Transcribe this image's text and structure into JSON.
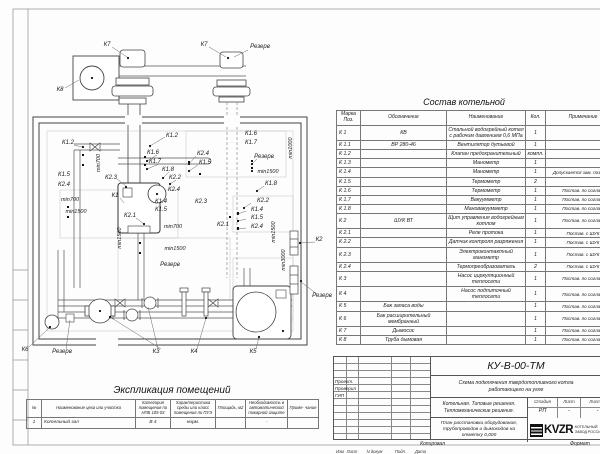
{
  "drawing": {
    "labels": [
      "К7",
      "К7",
      "Резерв",
      "К8",
      "К1.2",
      "min700",
      "К1.5",
      "К2.4",
      "min700",
      "min1500",
      "К1.2",
      "К1.6",
      "К1.7",
      "К1.8",
      "К2.2",
      "К2.3",
      "К1",
      "К2.1",
      "К2.4",
      "К1.5",
      "К2.4",
      "К2.3",
      "К1.4",
      "К1.5",
      "min700",
      "min1500",
      "Резерв",
      "min1500",
      "К1.6",
      "К1.7",
      "Резерв",
      "min1000",
      "min1500",
      "К1.8",
      "К2.2",
      "К1.4",
      "К1.5",
      "К2.4",
      "К2.1",
      "min1500",
      "min3000",
      "К2",
      "Резерв",
      "К6",
      "Резерв",
      "К3",
      "К4",
      "К5"
    ]
  },
  "spec_table": {
    "title": "Состав котельной",
    "headers": [
      "Марка Поз.",
      "Обозначение",
      "Наименование",
      "Кол.",
      "Примечание"
    ],
    "rows": [
      [
        "К 1",
        "КВ",
        "Стальной водогрейный котел с рабочим давлением 0,6 МПа",
        "1",
        ""
      ],
      [
        "К 1.1",
        "ВР 280-46",
        "Вентилятор дутьевой",
        "1",
        ""
      ],
      [
        "К 1.2",
        "",
        "Клапан предохранительный",
        "компл.",
        ""
      ],
      [
        "К 1.3",
        "",
        "Манометр",
        "1",
        ""
      ],
      [
        "К 1.4",
        "",
        "Манометр",
        "1",
        "Допускается зам. поз. К 2.3"
      ],
      [
        "К 1.5",
        "",
        "Термометр",
        "2",
        ""
      ],
      [
        "К 1.6",
        "",
        "Термометр",
        "1",
        "Постав. по соглас."
      ],
      [
        "К 1.7",
        "",
        "Вакуумметр",
        "1",
        "Постав. по соглас."
      ],
      [
        "К 1.8",
        "",
        "Мановакуумметр",
        "1",
        "Постав. по соглас."
      ],
      [
        "К 2",
        "ШУК ВТ",
        "Щит управления водогрейным котлом",
        "1",
        "Постав. по соглас."
      ],
      [
        "К 2.1",
        "",
        "Реле протока",
        "1",
        "Постав. с ШУК"
      ],
      [
        "К 2.2",
        "",
        "Датчик контроля разряжения",
        "1",
        "Постав. с ШУК"
      ],
      [
        "К 2.3",
        "",
        "Электроконтактный манометр",
        "1",
        "Постав. с ШУК"
      ],
      [
        "К 2.4",
        "",
        "Термопреобразователь",
        "2",
        "Постав. с ШУК"
      ],
      [
        "К 3",
        "",
        "Насос циркуляционный теплосети",
        "1",
        "Постав. по соглас."
      ],
      [
        "К 4",
        "",
        "Насос подпиточный теплосети",
        "1",
        "Постав. по соглас."
      ],
      [
        "К 5",
        "Бак запаса воды",
        "",
        "1",
        "Постав. по соглас."
      ],
      [
        "К 6",
        "Бак расширительный мембранный",
        "",
        "1",
        "Постав. по соглас."
      ],
      [
        "К 7",
        "Дымосос",
        "",
        "1",
        "Постав. по соглас."
      ],
      [
        "К 8",
        "Труба дымовая",
        "",
        "1",
        "Постав. по соглас."
      ]
    ]
  },
  "explication_table": {
    "title": "Экспликация помещений",
    "headers": [
      "№",
      "Наименование цеха или участка",
      "Категория помещения по НПБ 105-03",
      "Характеристика среды или класс помещения по ПУЭ",
      "Площадь, м2",
      "Необходимость в автоматической пожарной защите",
      "Приме- чание"
    ],
    "rows": [
      [
        "1",
        "Котельный зал",
        "В 4",
        "норм.",
        "",
        "-",
        ""
      ]
    ]
  },
  "title_block": {
    "doc_code": "КУ-В-00-ТМ",
    "subtitle": "Схема подключения твердотопливного котла работающего на угле",
    "project_line1": "Котельная. Типовые решения.",
    "project_line2": "Тепломеханические решения.",
    "sheet_desc": "План расстановки оборудования, трубопроводов и дымоходов на отметку 0,000",
    "rev_headers": [
      "Изм",
      "Лист",
      "N докум",
      "Подп.",
      "Дата"
    ],
    "roles": [
      "Проект.",
      "Проверил",
      "ГИП"
    ],
    "stage_label": "Стадия",
    "sheet_label": "Лист",
    "sheets_label": "Листов",
    "stage": "РП",
    "sheet": "-",
    "sheets": "-",
    "logo_text": "KVZR",
    "logo_sub1": "КОТЕЛЬНЫЙ",
    "logo_sub2": "ЗАВОД РОССИИ",
    "copied_label": "Копировал",
    "format_label": "Формат"
  }
}
